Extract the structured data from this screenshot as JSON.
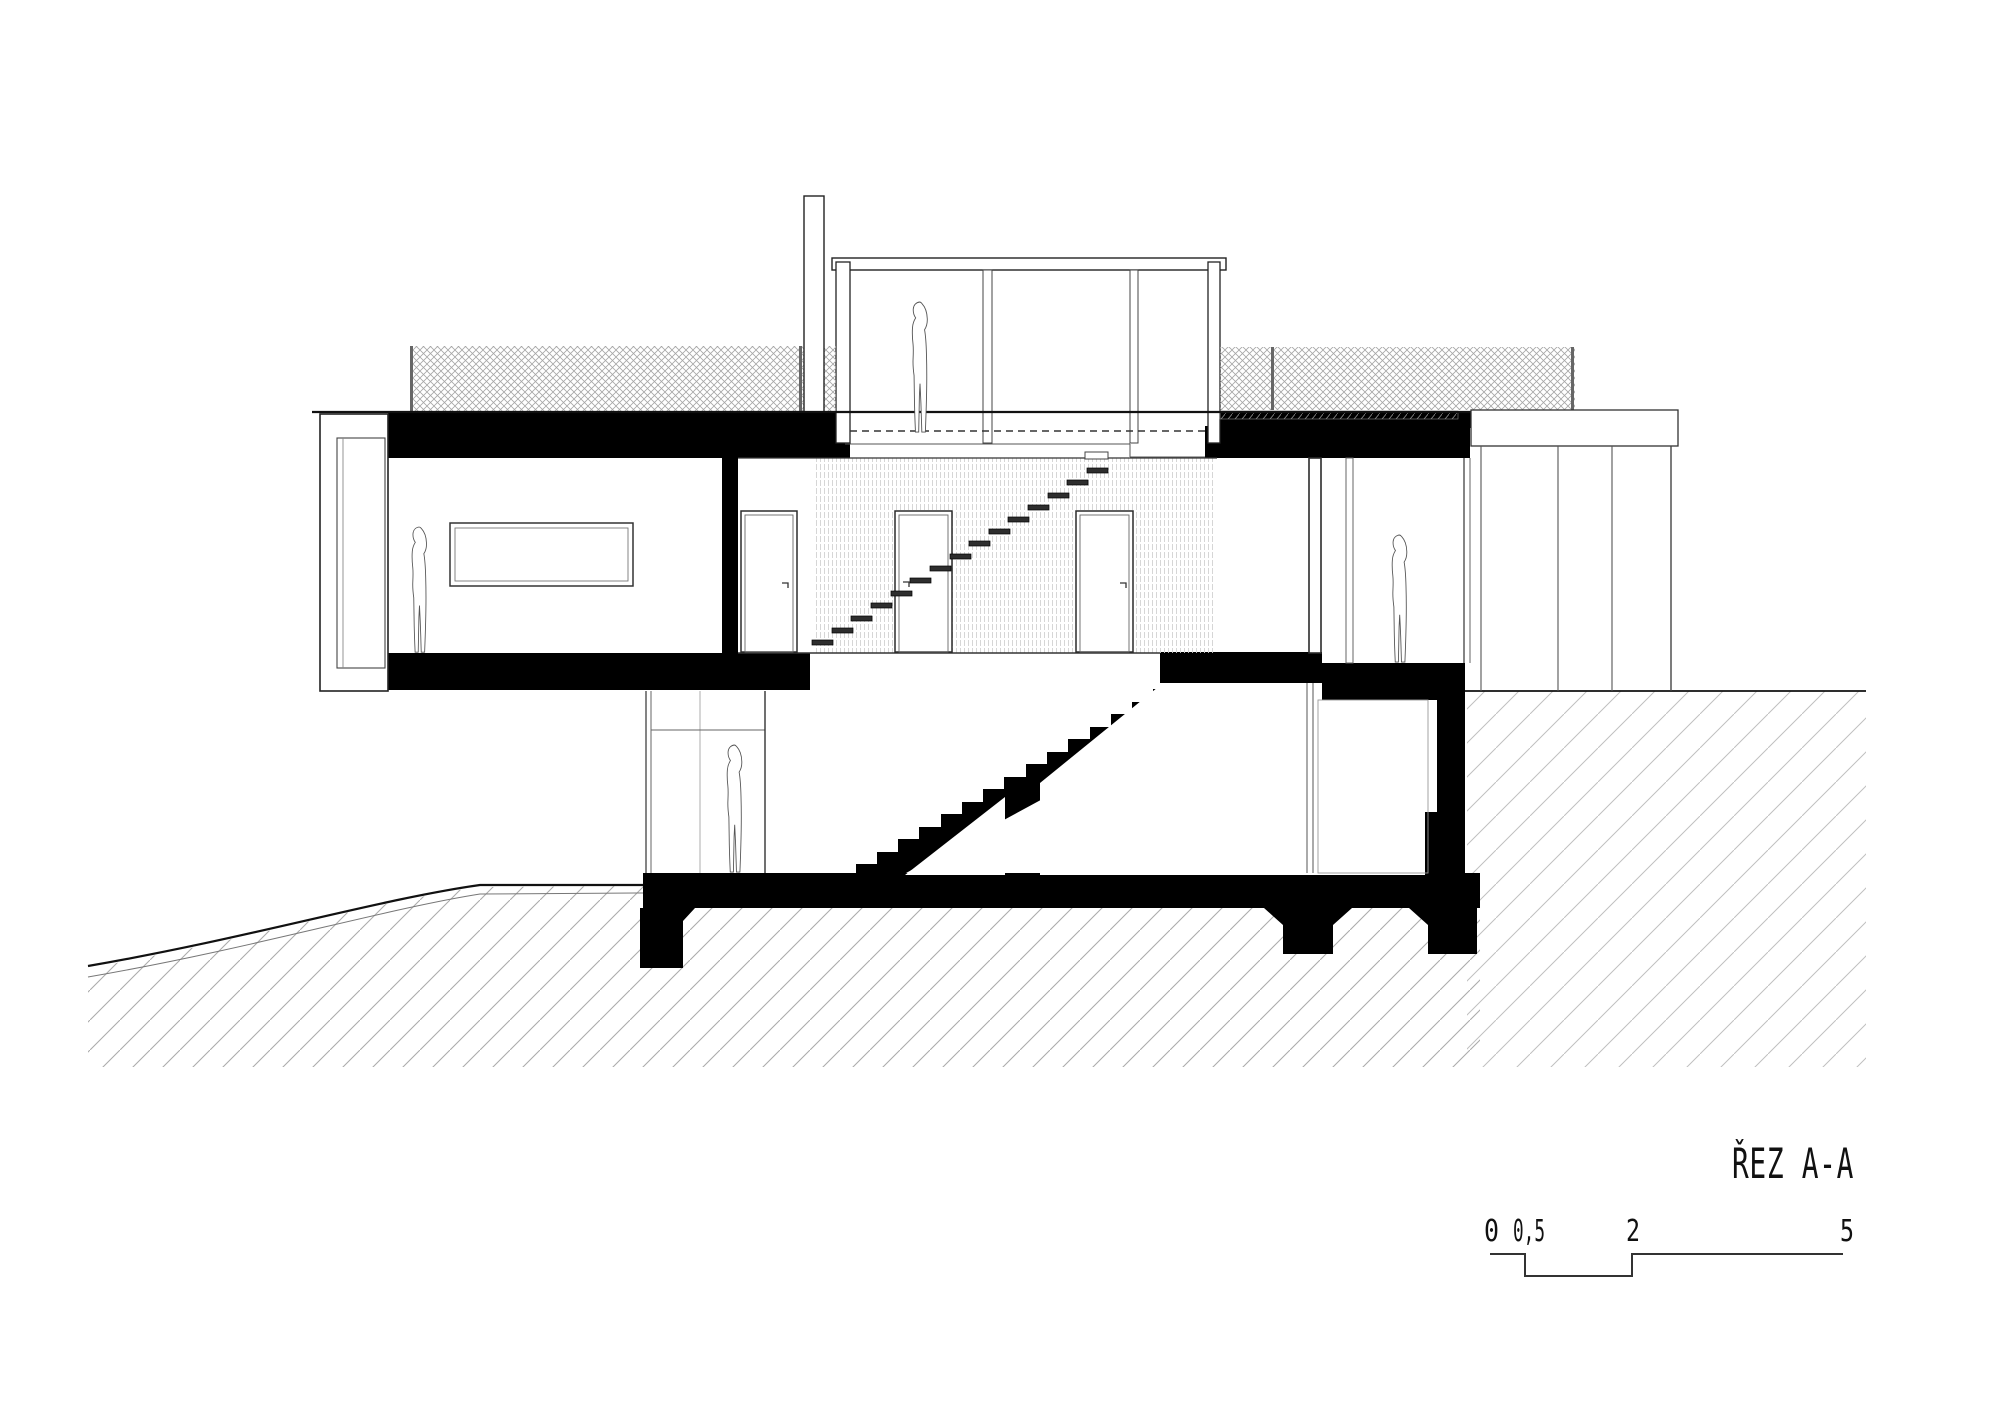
{
  "title": {
    "label": "ŘEZ A-A"
  },
  "scale_bar": {
    "labels": [
      "0",
      "0,5",
      "2",
      "5"
    ]
  },
  "colors": {
    "ink": "#1a1a1a",
    "section_fill": "#000000",
    "earth_hatch": "#ababab",
    "mesh_hatch": "#a6a6a6",
    "slat_hatch": "#d2d2d2",
    "background": "#ffffff"
  }
}
